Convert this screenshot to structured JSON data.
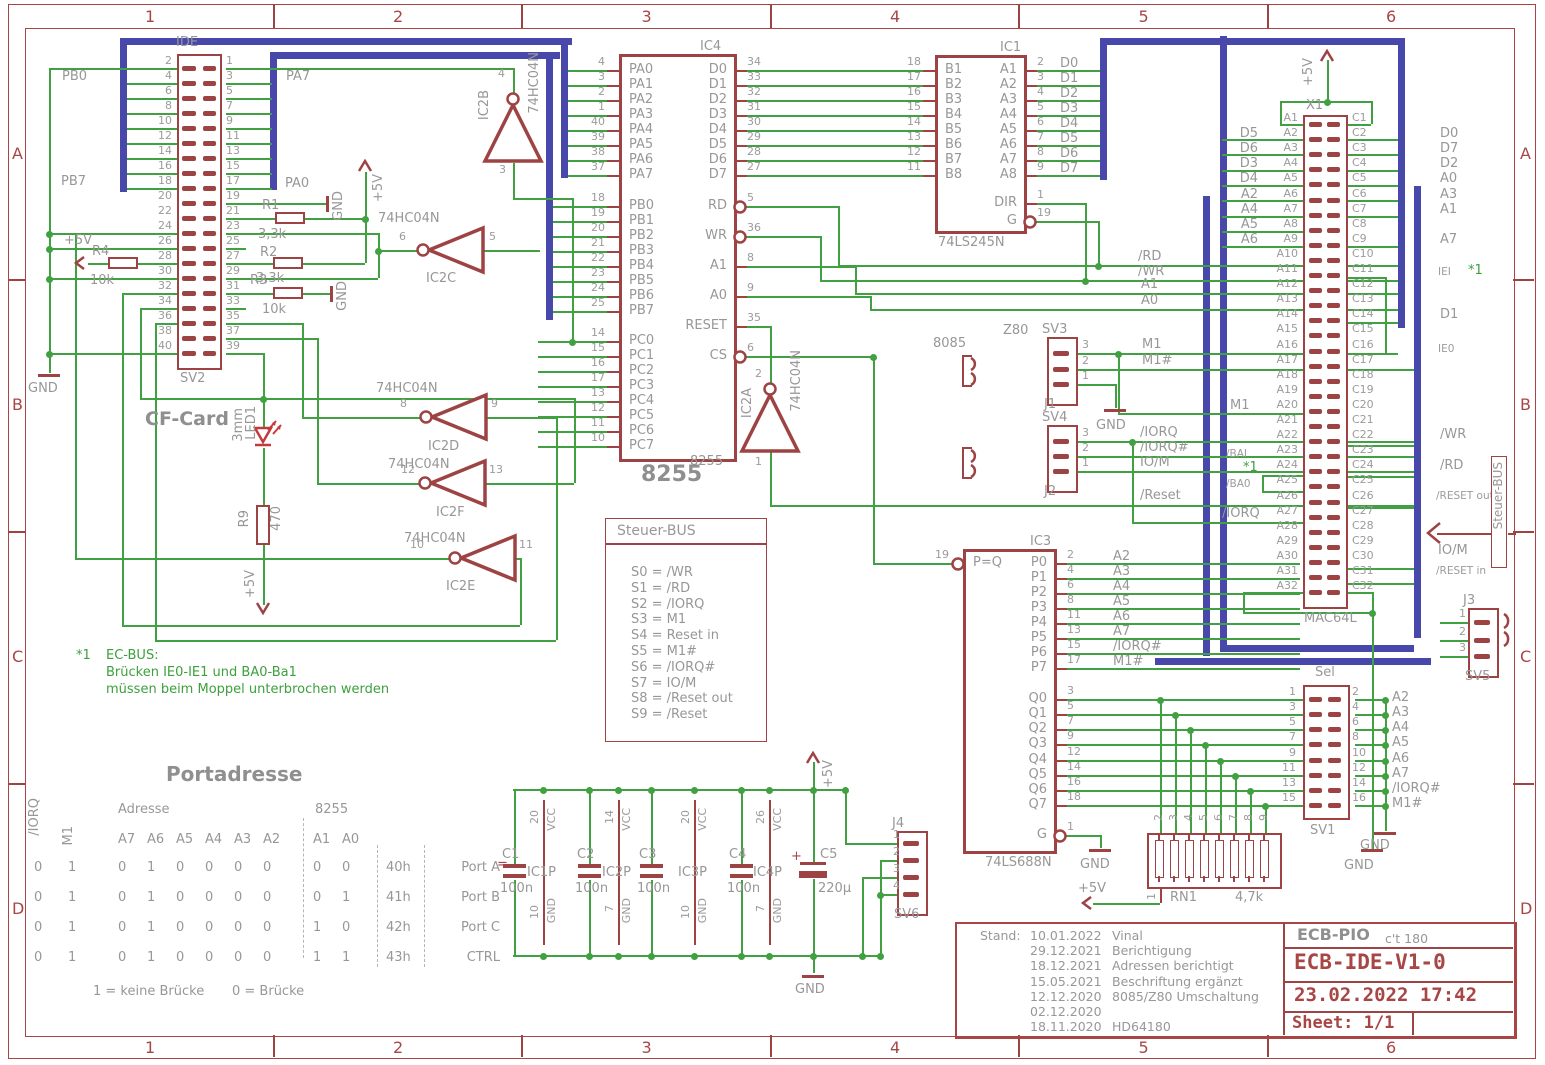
{
  "frame": {
    "cols": [
      "1",
      "2",
      "3",
      "4",
      "5",
      "6"
    ],
    "rows": [
      "A",
      "B",
      "C",
      "D"
    ]
  },
  "title_block": {
    "stand": "Stand:",
    "revisions": [
      {
        "date": "10.01.2022",
        "note": "Vinal"
      },
      {
        "date": "29.12.2021",
        "note": "Berichtigung"
      },
      {
        "date": "18.12.2021",
        "note": "Adressen berichtigt"
      },
      {
        "date": "15.05.2021",
        "note": "Beschriftung ergänzt"
      },
      {
        "date": "12.12.2020",
        "note": "8085/Z80 Umschaltung"
      },
      {
        "date": "02.12.2020",
        "note": ""
      },
      {
        "date": "18.11.2020",
        "note": "HD64180"
      }
    ],
    "project": "ECB-PIO",
    "project_ref": "c't 180",
    "board": "ECB-IDE-V1-0",
    "datetime": "23.02.2022 17:42",
    "sheet": "Sheet: 1/1"
  },
  "steuer_box": {
    "title": "Steuer-BUS",
    "entries": [
      "S0 = /WR",
      "S1 = /RD",
      "S2 = /IORQ",
      "S3 = M1",
      "S4 = Reset in",
      "S5 = M1#",
      "S6 = /IORQ#",
      "S7 = IO/M",
      "S8 = /Reset out",
      "S9 = /Reset"
    ]
  },
  "steuer_tag": "Steuer-BUS",
  "note": {
    "star": "*1",
    "l1": "EC-BUS:",
    "l2": "Brücken IE0-IE1 und BA0-Ba1",
    "l3": "müssen beim Moppel unterbrochen werden"
  },
  "port_table": {
    "title": "Portadresse",
    "iorq": "/IORQ",
    "m1": "M1",
    "adresse": "Adresse",
    "abits": [
      "A7",
      "A6",
      "A5",
      "A4",
      "A3",
      "A2"
    ],
    "i8255": "8255",
    "a1": "A1",
    "a0": "A0",
    "rows": [
      {
        "io": "0",
        "m": "1",
        "bits": [
          "0",
          "1",
          "0",
          "0",
          "0",
          "0"
        ],
        "a1": "0",
        "a0": "0",
        "hex": "40h",
        "name": "Port A"
      },
      {
        "io": "0",
        "m": "1",
        "bits": [
          "0",
          "1",
          "0",
          "0",
          "0",
          "0"
        ],
        "a1": "0",
        "a0": "1",
        "hex": "41h",
        "name": "Port B"
      },
      {
        "io": "0",
        "m": "1",
        "bits": [
          "0",
          "1",
          "0",
          "0",
          "0",
          "0"
        ],
        "a1": "1",
        "a0": "0",
        "hex": "42h",
        "name": "Port C"
      },
      {
        "io": "0",
        "m": "1",
        "bits": [
          "0",
          "1",
          "0",
          "0",
          "0",
          "0"
        ],
        "a1": "1",
        "a0": "1",
        "hex": "43h",
        "name": "CTRL"
      }
    ],
    "foot1": "1 = keine Brücke",
    "foot2": "0 = Brücke",
    "eq": "="
  },
  "sv2": {
    "name": "IDE",
    "ref": "SV2",
    "left": [
      "2",
      "4",
      "6",
      "8",
      "10",
      "12",
      "14",
      "16",
      "18",
      "20",
      "22",
      "24",
      "26",
      "28",
      "30",
      "32",
      "34",
      "36",
      "38",
      "40"
    ],
    "right": [
      "1",
      "3",
      "5",
      "7",
      "9",
      "11",
      "13",
      "15",
      "17",
      "19",
      "21",
      "23",
      "25",
      "27",
      "29",
      "31",
      "33",
      "35",
      "37",
      "39"
    ]
  },
  "ic4": {
    "ref": "IC4",
    "val": "8255",
    "big": "8255",
    "left": [
      [
        "PA0",
        "4"
      ],
      [
        "PA1",
        "3"
      ],
      [
        "PA2",
        "2"
      ],
      [
        "PA3",
        "1"
      ],
      [
        "PA4",
        "40"
      ],
      [
        "PA5",
        "39"
      ],
      [
        "PA6",
        "38"
      ],
      [
        "PA7",
        "37"
      ],
      [
        "PB0",
        "18"
      ],
      [
        "PB1",
        "19"
      ],
      [
        "PB2",
        "20"
      ],
      [
        "PB3",
        "21"
      ],
      [
        "PB4",
        "22"
      ],
      [
        "PB5",
        "23"
      ],
      [
        "PB6",
        "24"
      ],
      [
        "PB7",
        "25"
      ],
      [
        "PC0",
        "14"
      ],
      [
        "PC1",
        "15"
      ],
      [
        "PC2",
        "16"
      ],
      [
        "PC3",
        "17"
      ],
      [
        "PC4",
        "13"
      ],
      [
        "PC5",
        "12"
      ],
      [
        "PC6",
        "11"
      ],
      [
        "PC7",
        "10"
      ]
    ],
    "right": [
      [
        "D0",
        "34",
        ""
      ],
      [
        "D1",
        "33",
        ""
      ],
      [
        "D2",
        "32",
        ""
      ],
      [
        "D3",
        "31",
        ""
      ],
      [
        "D4",
        "30",
        ""
      ],
      [
        "D5",
        "29",
        ""
      ],
      [
        "D6",
        "28",
        ""
      ],
      [
        "D7",
        "27",
        ""
      ],
      [
        "RD",
        "5",
        "",
        1
      ],
      [
        "WR",
        "36",
        "",
        1
      ],
      [
        "A1",
        "8",
        ""
      ],
      [
        "A0",
        "9",
        ""
      ],
      [
        "RESET",
        "35",
        ""
      ],
      [
        "CS",
        "6",
        "",
        1
      ]
    ]
  },
  "ic1": {
    "ref": "IC1",
    "val": "74LS245N",
    "left": [
      [
        "B1",
        "18"
      ],
      [
        "B2",
        "17"
      ],
      [
        "B3",
        "16"
      ],
      [
        "B4",
        "15"
      ],
      [
        "B5",
        "14"
      ],
      [
        "B6",
        "13"
      ],
      [
        "B7",
        "12"
      ],
      [
        "B8",
        "11"
      ]
    ],
    "right": [
      [
        "A1",
        "2",
        "D0"
      ],
      [
        "A2",
        "3",
        "D1"
      ],
      [
        "A3",
        "4",
        "D2"
      ],
      [
        "A4",
        "5",
        "D3"
      ],
      [
        "A5",
        "6",
        "D4"
      ],
      [
        "A6",
        "7",
        "D5"
      ],
      [
        "A7",
        "8",
        "D6"
      ],
      [
        "A8",
        "9",
        "D7"
      ],
      [
        "DIR",
        "1",
        ""
      ],
      [
        "G",
        "19",
        "",
        1
      ]
    ]
  },
  "ic3": {
    "ref": "IC3",
    "val": "74LS688N",
    "left": [
      [
        "P=Q",
        "19",
        "",
        1
      ]
    ],
    "right": [
      [
        "P0",
        "2",
        "A2"
      ],
      [
        "P1",
        "4",
        "A3"
      ],
      [
        "P2",
        "6",
        "A4"
      ],
      [
        "P3",
        "8",
        "A5"
      ],
      [
        "P4",
        "11",
        "A6"
      ],
      [
        "P5",
        "13",
        "A7"
      ],
      [
        "P6",
        "15",
        "/IORQ#"
      ],
      [
        "P7",
        "17",
        "M1#"
      ],
      [
        "Q0",
        "3",
        ""
      ],
      [
        "Q1",
        "5",
        ""
      ],
      [
        "Q2",
        "7",
        ""
      ],
      [
        "Q3",
        "9",
        ""
      ],
      [
        "Q4",
        "12",
        ""
      ],
      [
        "Q5",
        "14",
        ""
      ],
      [
        "Q6",
        "16",
        ""
      ],
      [
        "Q7",
        "18",
        ""
      ],
      [
        "G",
        "1",
        "",
        1
      ]
    ]
  },
  "x1": {
    "ref": "X1",
    "val": "MAC64L",
    "lp": "A",
    "rp": "C",
    "n": 32,
    "lnets": [
      "D5",
      "D6",
      "D3",
      "D4",
      "A2",
      "A4",
      "A5",
      "A6"
    ],
    "rnets": [
      [
        "1",
        "D0"
      ],
      [
        "2",
        "D7"
      ],
      [
        "3",
        "D2"
      ],
      [
        "4",
        "A0"
      ],
      [
        "5",
        "A3"
      ],
      [
        "6",
        "A1"
      ],
      [
        "8",
        "A7"
      ],
      [
        "13",
        "D1"
      ]
    ]
  },
  "sv1": {
    "top": "Sel",
    "ref": "SV1",
    "left": [
      "1",
      "3",
      "5",
      "7",
      "9",
      "11",
      "13",
      "15"
    ],
    "right": [
      "2",
      "4",
      "6",
      "8",
      "10",
      "12",
      "14",
      "16"
    ],
    "nets": [
      "A2",
      "A3",
      "A4",
      "A5",
      "A6",
      "A7",
      "/IORQ#",
      "M1#"
    ]
  },
  "sv3": {
    "top": "SV3",
    "bot": "J1",
    "pins": [
      "3",
      "2",
      "1"
    ]
  },
  "sv4": {
    "top": "SV4",
    "bot": "J2",
    "pins": [
      "3",
      "2",
      "1"
    ]
  },
  "j3": {
    "top": "J3",
    "bot": "SV5",
    "pins": [
      "1",
      "2",
      "3"
    ]
  },
  "j4": {
    "top": "J4",
    "bot": "SV6",
    "pins": [
      "1",
      "2",
      "3",
      "4"
    ]
  },
  "rn1": {
    "ref": "RN1",
    "val": "4,7k",
    "top": [
      "2",
      "3",
      "4",
      "5",
      "6",
      "7",
      "8",
      "9"
    ],
    "p1": "1"
  },
  "caps": {
    "list": [
      {
        "r": "C1",
        "v": "100n",
        "p": "IC1P",
        "vcc": "20",
        "gnd": "10"
      },
      {
        "r": "C2",
        "v": "100n",
        "p": "IC2P",
        "vcc": "14",
        "gnd": "7"
      },
      {
        "r": "C3",
        "v": "100n",
        "p": "IC3P",
        "vcc": "20",
        "gnd": "10"
      },
      {
        "r": "C4",
        "v": "100n",
        "p": "IC4P",
        "vcc": "26",
        "gnd": "7"
      }
    ],
    "c5": {
      "r": "C5",
      "v": "220µ",
      "plus": "+"
    },
    "vcc": "VCC",
    "gndl": "GND"
  },
  "gates": {
    "part": "74HC04N",
    "list": [
      {
        "n": "IC2A",
        "i": "1",
        "o": "2"
      },
      {
        "n": "IC2B",
        "i": "3",
        "o": "4"
      },
      {
        "n": "IC2C",
        "i": "5",
        "o": "6"
      },
      {
        "n": "IC2D",
        "i": "9",
        "o": "8"
      },
      {
        "n": "IC2E",
        "i": "11",
        "o": "10"
      },
      {
        "n": "IC2F",
        "i": "13",
        "o": "12"
      }
    ]
  },
  "labels": {
    "pb0": "PB0",
    "pb7": "PB7",
    "pa7": "PA7",
    "pa0": "PA0",
    "gnd": "GND",
    "p5v": "+5V",
    "cf": "CF-Card",
    "mm": "3mm",
    "led1": "LED1",
    "r9": "R9",
    "r9v": "470",
    "r1": "R1",
    "r2": "R2",
    "r3": "R3",
    "r4": "R4",
    "v33": "3,3k",
    "v10k": "10k",
    "z80": "Z80",
    "i8085": "8085",
    "rd": "/RD",
    "wr": "/WR",
    "a0": "A0",
    "a1": "A1",
    "m1": "M1",
    "m1h": "M1#",
    "iorq": "/IORQ",
    "iorqh": "/IORQ#",
    "iom": "IO/M",
    "rst": "/Reset",
    "rsto": "/RESET out",
    "rsti": "/RESET in",
    "bai": "/BAI",
    "ba0": "/BA0",
    "star": "*1",
    "iei": "IEI",
    "ie0": "IE0"
  }
}
